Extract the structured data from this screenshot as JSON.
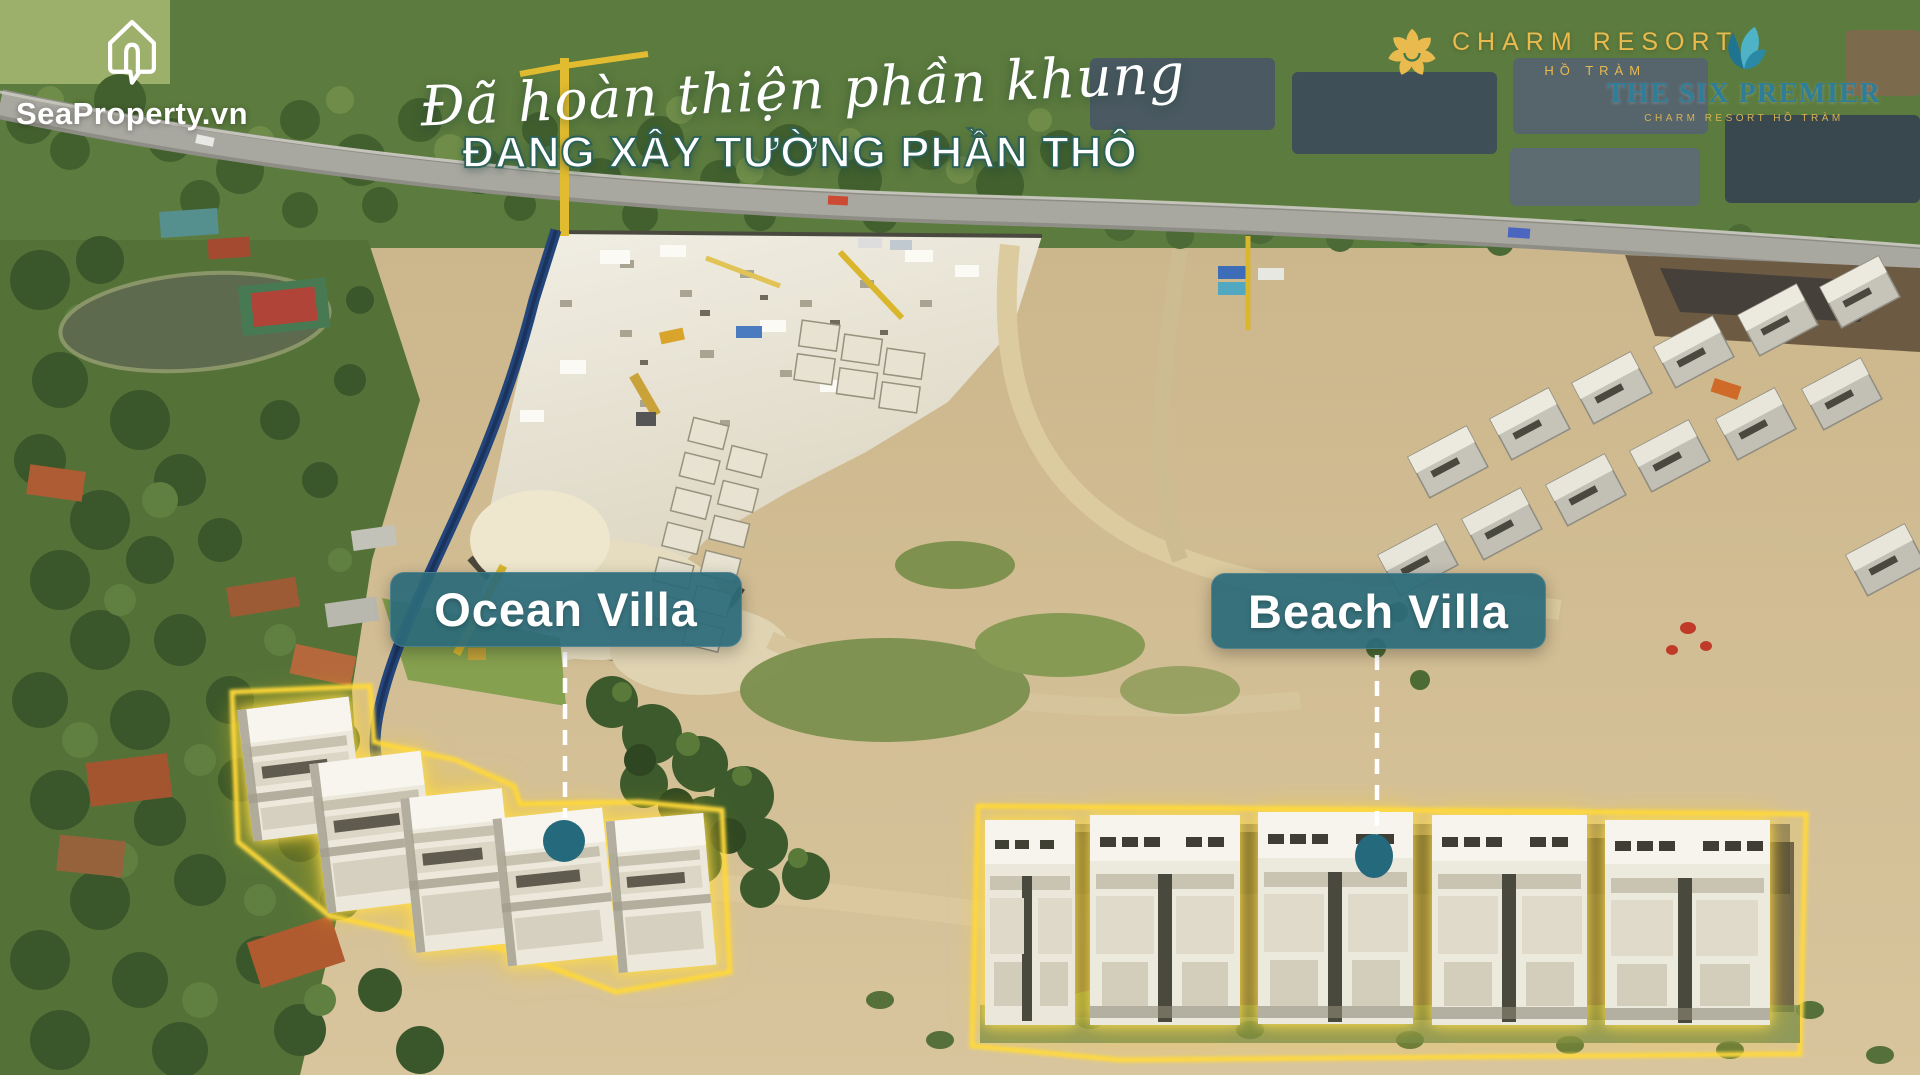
{
  "watermark": {
    "text": "SeaProperty.vn",
    "icon": "house-chat-bubble-icon"
  },
  "headline": {
    "script_line": "Đã hoàn thiện phần khung",
    "bold_line": "ĐANG XÂY TƯỜNG PHẦN THÔ"
  },
  "brands": {
    "charm_resort": {
      "name": "CHARM RESORT",
      "location": "HỒ TRÀM",
      "icon": "pinwheel-flower-icon"
    },
    "six_premier": {
      "name": "THE SIX PREMIER",
      "subtitle": "CHARM RESORT HỒ TRÀM",
      "icon": "nautilus-shell-icon"
    }
  },
  "annotations": {
    "ocean_villa": {
      "label": "Ocean Villa"
    },
    "beach_villa": {
      "label": "Beach Villa"
    }
  },
  "colors": {
    "label_teal_bg": "rgba(43,106,122,0.93)",
    "marker_teal": "#25697c",
    "highlight_gold": "#ffd93e",
    "brand_gold": "#e9ba4e",
    "brand_teal": "#2f7e99",
    "headline_stroke": "#2c6157"
  }
}
